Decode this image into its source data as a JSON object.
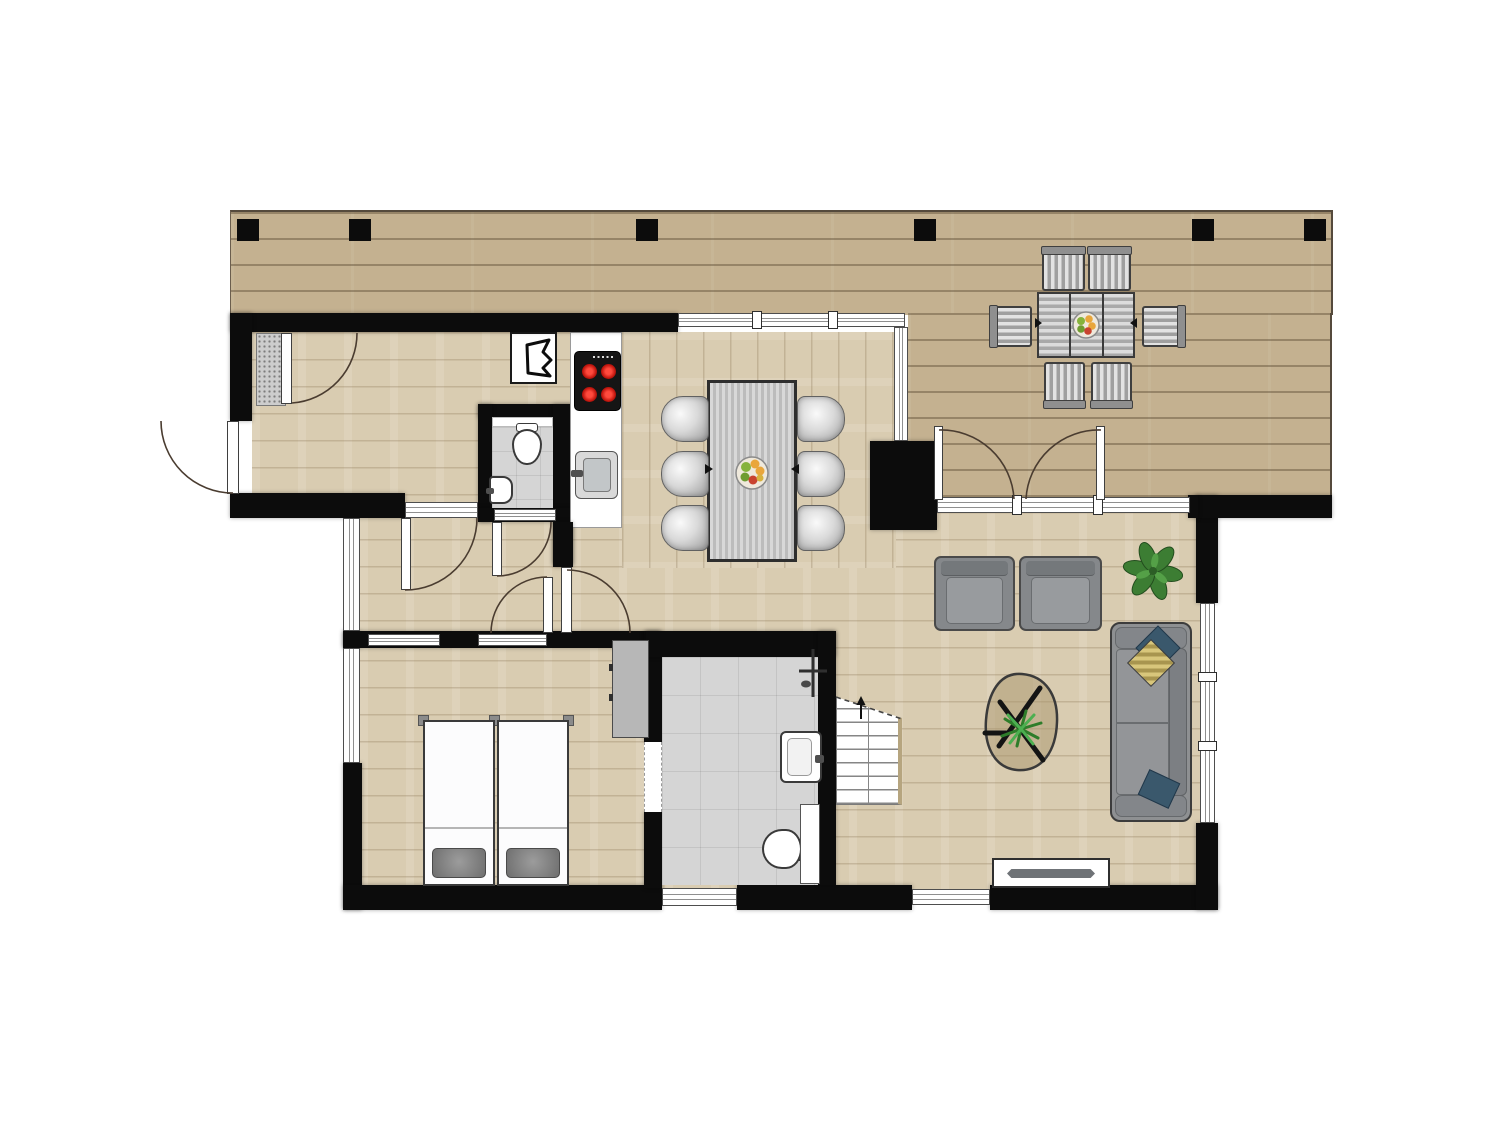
{
  "plan": {
    "kind": "architectural-floor-plan",
    "canvas": {
      "width": 1500,
      "height": 1125
    },
    "palette": {
      "background": "#ffffff",
      "walls": "#0c0c0c",
      "deck_wood": "#c4b190",
      "interior_wood": "#d9ccb1",
      "tile": "#d5d5d5",
      "sofa_gray": "#8e9092",
      "burner_red": "#c2160e",
      "stringer_tan": "#b6a57f",
      "pillow_yellow": "#d8c67b",
      "pillow_navy": "#3a586c",
      "plant_green": "#3c7d33",
      "fixture_white": "#ffffff"
    },
    "rooms": [
      {
        "name": "deck-terrace"
      },
      {
        "name": "entry-hall"
      },
      {
        "name": "corridor"
      },
      {
        "name": "guest-toilet"
      },
      {
        "name": "kitchen"
      },
      {
        "name": "dining-area"
      },
      {
        "name": "living-room"
      },
      {
        "name": "bedroom"
      },
      {
        "name": "bathroom"
      },
      {
        "name": "staircase"
      }
    ],
    "objects": [
      {
        "name": "deck-post",
        "count": 6
      },
      {
        "name": "outdoor-dining-table",
        "count": 1
      },
      {
        "name": "outdoor-chair",
        "count": 6
      },
      {
        "name": "fruit-bowl",
        "count": 2
      },
      {
        "name": "dining-table",
        "count": 1
      },
      {
        "name": "dining-chair",
        "count": 6
      },
      {
        "name": "kitchen-counter",
        "count": 1
      },
      {
        "name": "cooktop-4-burners",
        "count": 1
      },
      {
        "name": "kitchen-sink",
        "count": 1
      },
      {
        "name": "boiler-unit",
        "count": 1
      },
      {
        "name": "toilet",
        "count": 2
      },
      {
        "name": "hand-basin",
        "count": 1
      },
      {
        "name": "bathroom-sink",
        "count": 1
      },
      {
        "name": "shower",
        "count": 1
      },
      {
        "name": "armchair",
        "count": 2
      },
      {
        "name": "sofa",
        "count": 1
      },
      {
        "name": "sofa-pillow",
        "count": 3
      },
      {
        "name": "coffee-table",
        "count": 1
      },
      {
        "name": "house-plant",
        "count": 2
      },
      {
        "name": "radiator",
        "count": 1
      },
      {
        "name": "single-bed",
        "count": 2
      },
      {
        "name": "wardrobe",
        "count": 1
      },
      {
        "name": "stairs-up",
        "count": 1
      },
      {
        "name": "french-doors-to-deck",
        "count": 1
      },
      {
        "name": "front-door",
        "count": 1
      },
      {
        "name": "interior-door",
        "count": 5
      },
      {
        "name": "doormat",
        "count": 1
      },
      {
        "name": "chimney-block",
        "count": 1
      }
    ]
  }
}
